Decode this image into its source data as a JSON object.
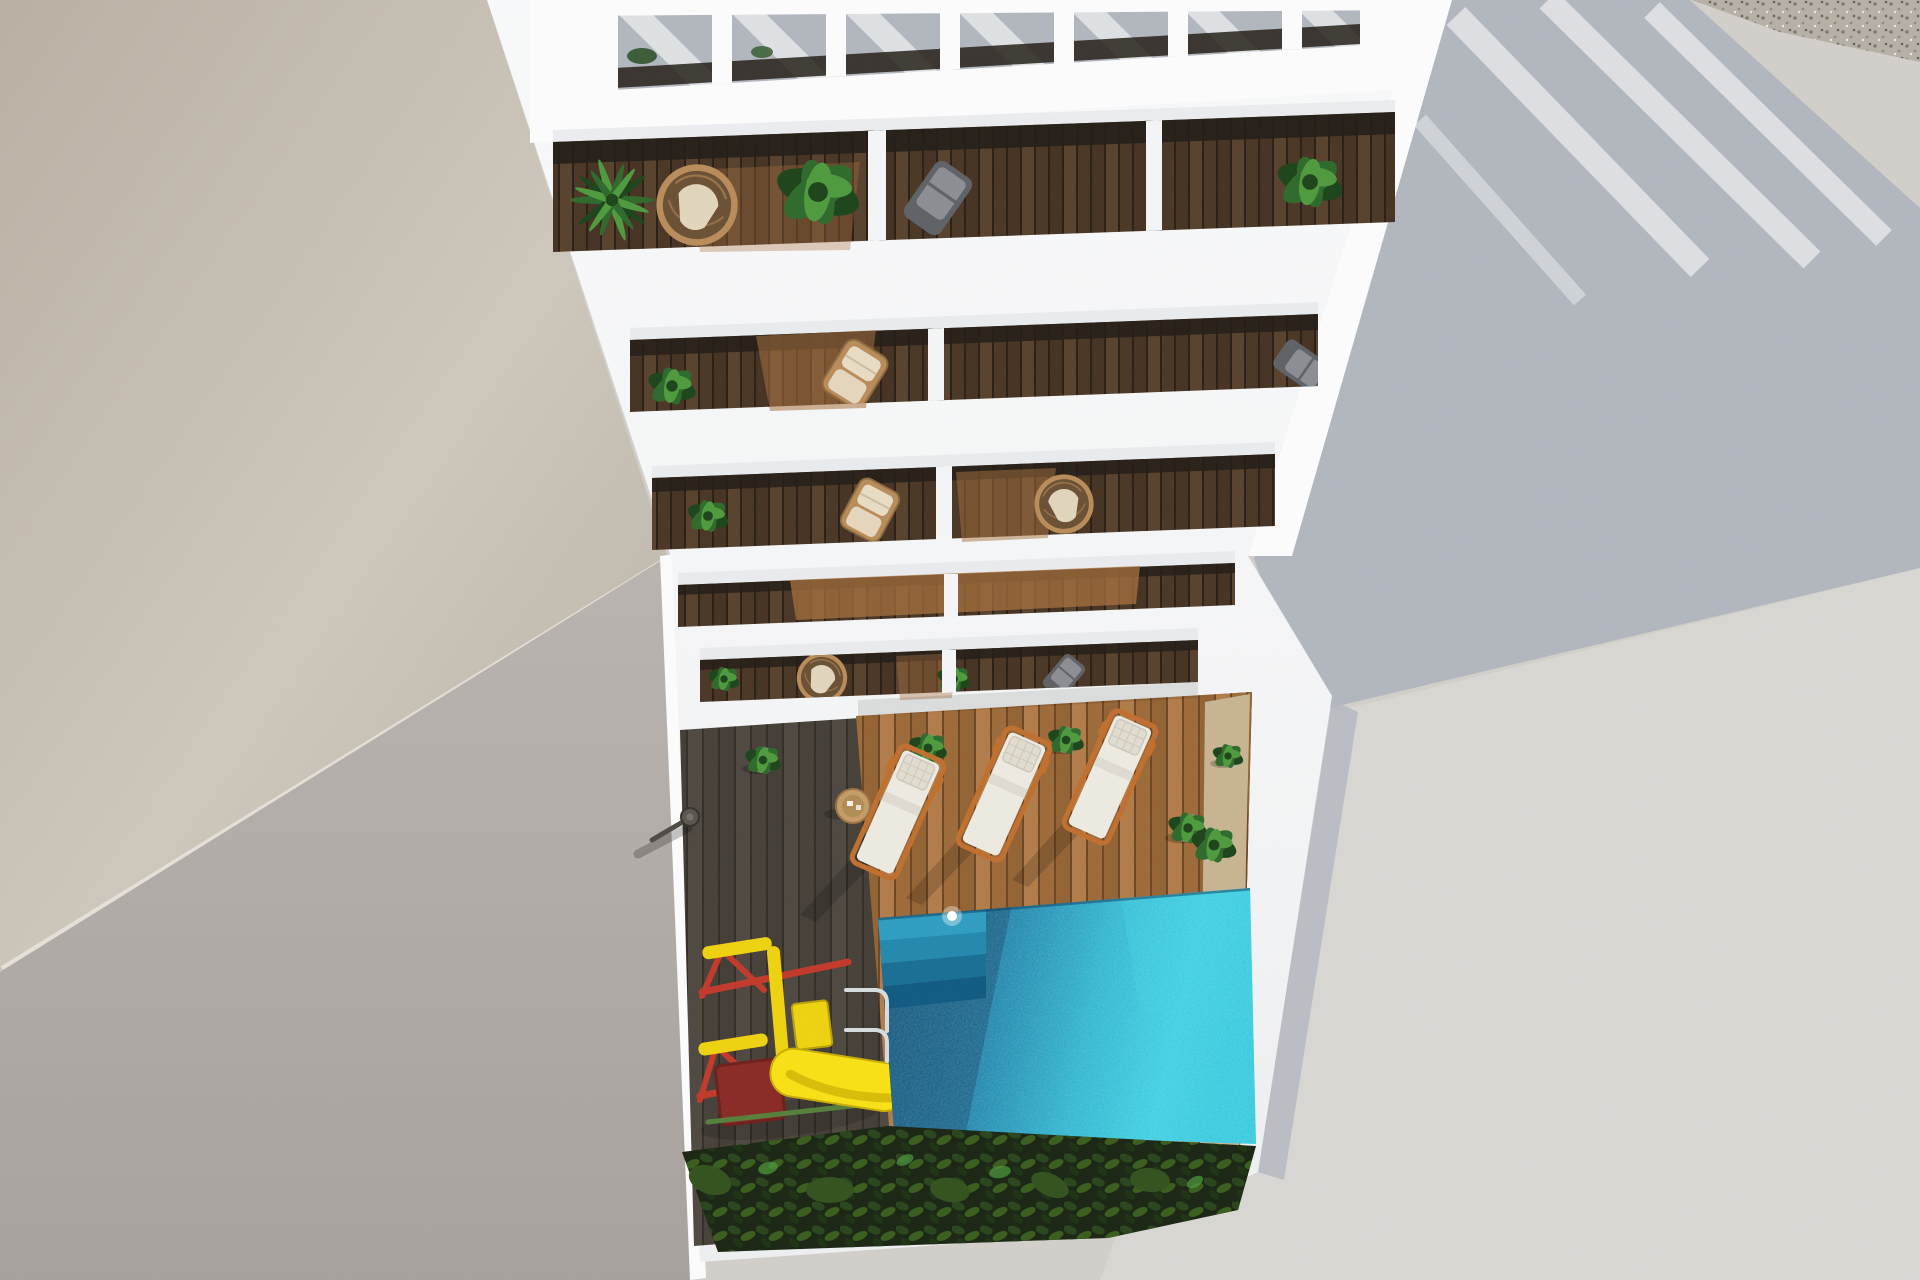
{
  "meta": {
    "title": "Aerial 3D architectural render: white apartment building with stacked balconies, courtyard wood deck, turquoise swimming pool, sun loungers and children's slide"
  },
  "colors": {
    "pavement": "#d2cfca",
    "pavement_sun": "#dbd9d5",
    "pavement_shadow": "#b2b7bf",
    "shadow_stripe": "#e2e4e7",
    "beige_light": "#cfc8bd",
    "beige_dark": "#b9b0a3",
    "wall_gray": "#b2acaa",
    "building_white": "#f4f5f6",
    "building_bright": "#fcfcfd",
    "building_shade": "#e4e7ea",
    "glass_dark": "#241e18",
    "wood_lit": "#a8713f",
    "balcony_wood": "#503c2a",
    "deck_shade": "#45403a",
    "deck_sun": "#a8713f",
    "sand": "#c9b48e",
    "pool_deep": "#10587f",
    "pool_mid": "#1a85ad",
    "pool_bright": "#36cfe2",
    "pool_shadow": "#0b466b",
    "pool_step": "#2f9ec2",
    "sparkle": "#ffffff",
    "bush_dark": "#1b2614",
    "bush_leaf": "#34531f",
    "plant_green": "#2f6a2c",
    "plant_green_dark": "#1d451b",
    "plant_green_light": "#4f9a3e",
    "rattan": "#b98c5a",
    "rattan_dark": "#6b5134",
    "cushion_cream": "#e8dcc4",
    "chair_gray": "#5f6266",
    "chair_gray_light": "#94979b",
    "lounger_cushion": "#edeae2",
    "lounger_pillow": "#e2ddd1",
    "lounger_frame": "#c0702f",
    "table_wood": "#c59c66",
    "slide_yellow": "#f9e116",
    "play_yellow": "#eed211",
    "play_red": "#c23a2c",
    "play_red_dark": "#892b27",
    "chrome": "#d7dcdf",
    "gravel": "#b5afa4",
    "gravel_dot": "#6f6a60"
  },
  "scene": {
    "description": "Top-down view of a white residential tower. A slatted pergola crowns the penthouse terrace; five balcony levels with dark wood decks, plants and chairs step down to a private courtyard containing a plank deck, three sun loungers, potted plants, an outdoor shower, a red-and-yellow play structure with slide, a hedge row and a turquoise pool with steps and ladder. Surrounding pavement carries long diagonal building shadows; a gravel strip touches the top-right corner.",
    "building": {
      "pergola_slats": 7,
      "balcony_levels": 5,
      "penthouse_terrace": 1,
      "balconies": [
        {
          "level": 1,
          "items": [
            "palm-plant",
            "rattan-chair",
            "strelitzia-plant",
            "sling-chair",
            "potted-plant"
          ]
        },
        {
          "level": 2,
          "items": [
            "potted-plant",
            "wicker-armchair"
          ]
        },
        {
          "level": 3,
          "items": [
            "potted-plant",
            "wicker-armchair",
            "rattan-chair"
          ]
        },
        {
          "level": 4,
          "items": []
        },
        {
          "level": 5,
          "items": [
            "potted-plant",
            "rattan-chair",
            "potted-plant",
            "sling-chair"
          ]
        }
      ]
    },
    "courtyard": {
      "sun_loungers": 3,
      "potted_plants": 6,
      "side_tables": 1,
      "outdoor_showers": 1,
      "hedge_rows": 1
    },
    "pool": {
      "ladders": 1,
      "steps": 4,
      "surface_highlights": 1
    },
    "playground": {
      "slides": 1,
      "climb_frames": 1
    }
  }
}
